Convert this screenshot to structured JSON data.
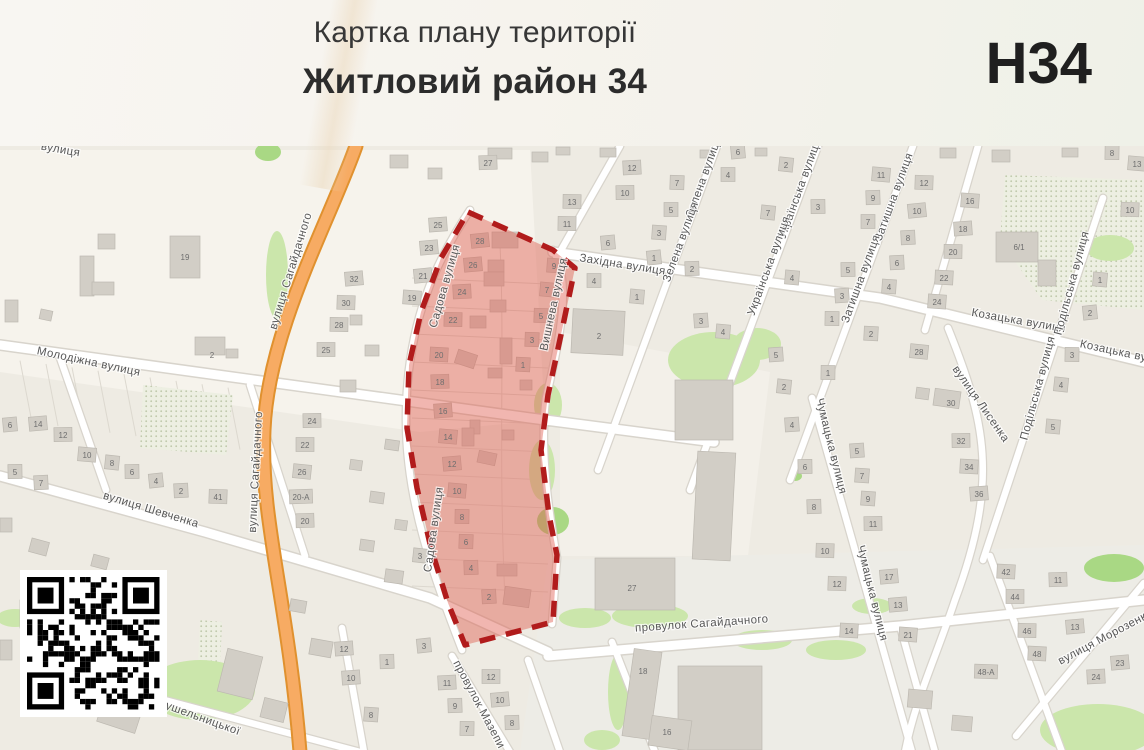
{
  "header": {
    "subtitle": "Картка плану території",
    "title": "Житловий район 34",
    "sheet_code": "Н34"
  },
  "map": {
    "colors": {
      "map_bg": "#EEEBE3",
      "highlight_fill": "#DE584C",
      "highlight_border": "#B11C1C",
      "road_orange": "#F7AB63",
      "green": "#CBE6AB",
      "building": "#D2CEC6"
    },
    "highlight": {
      "label": "Житловий район 34",
      "points": "468,212 553,250 575,268 562,330 548,395 541,450 549,515 557,555 553,622 465,645 448,603 431,548 417,488 407,428 409,365 421,312 441,258"
    },
    "street_labels": [
      [
        "Молодіжна вулиця",
        88,
        365,
        12
      ],
      [
        "вулиця Шевченка",
        150,
        513,
        17
      ],
      [
        "вулиця Сагайдачного",
        294,
        272,
        -73
      ],
      [
        "вулиця Сагайдачного",
        259,
        472,
        -87
      ],
      [
        "Західна вулиця",
        622,
        268,
        9
      ],
      [
        "Зелена вулиця",
        707,
        178,
        -70
      ],
      [
        "Зелена вулиця",
        684,
        243,
        -70
      ],
      [
        "Українська вулиця",
        803,
        190,
        -70
      ],
      [
        "Українська вулиця",
        772,
        267,
        -70
      ],
      [
        "Затишна вулиця",
        897,
        198,
        -70
      ],
      [
        "Затишна вулиця",
        864,
        280,
        -70
      ],
      [
        "Козацька вулиця",
        1018,
        324,
        10
      ],
      [
        "Козацька вулиця",
        1126,
        357,
        12
      ],
      [
        "Подільська вулиця",
        1075,
        284,
        -75
      ],
      [
        "Подільська вулиця",
        1041,
        389,
        -75
      ],
      [
        "вулиця Лисенка",
        978,
        406,
        55
      ],
      [
        "Чумацька вулиця",
        828,
        447,
        76
      ],
      [
        "Чумацька вулиця",
        869,
        594,
        76
      ],
      [
        "вулиця Морозенка",
        1107,
        640,
        -28
      ],
      [
        "провулок Сагайдачного",
        702,
        627,
        -4
      ],
      [
        "провулок Мазепи",
        476,
        706,
        62
      ],
      [
        "вулиця Крушельницької",
        175,
        712,
        20
      ],
      [
        "Садова вулиця",
        448,
        287,
        -74
      ],
      [
        "Садова вулиця",
        437,
        530,
        -82
      ],
      [
        "Вишнева вулиця",
        557,
        305,
        -78
      ],
      [
        "вулиця",
        60,
        153,
        10
      ]
    ],
    "house_numbers": [
      [
        "6",
        10,
        425
      ],
      [
        "14",
        38,
        424
      ],
      [
        "12",
        63,
        435
      ],
      [
        "10",
        87,
        455
      ],
      [
        "8",
        112,
        463
      ],
      [
        "6",
        132,
        472
      ],
      [
        "4",
        156,
        481
      ],
      [
        "2",
        181,
        491
      ],
      [
        "41",
        218,
        497
      ],
      [
        "7",
        41,
        483
      ],
      [
        "5",
        15,
        472
      ],
      [
        "2",
        212,
        355,
        0
      ],
      [
        "19",
        185,
        257,
        0
      ],
      [
        "25",
        326,
        350
      ],
      [
        "24",
        312,
        421
      ],
      [
        "22",
        305,
        445
      ],
      [
        "26",
        302,
        472
      ],
      [
        "20-А",
        301,
        497
      ],
      [
        "20",
        305,
        521
      ],
      [
        "32",
        354,
        279
      ],
      [
        "30",
        346,
        303
      ],
      [
        "28",
        339,
        325
      ],
      [
        "25",
        438,
        225
      ],
      [
        "23",
        429,
        248
      ],
      [
        "21",
        423,
        276
      ],
      [
        "19",
        412,
        298
      ],
      [
        "3",
        420,
        556
      ],
      [
        "27",
        488,
        163
      ],
      [
        "13",
        572,
        202
      ],
      [
        "11",
        567,
        224
      ],
      [
        "28",
        480,
        241
      ],
      [
        "26",
        473,
        265
      ],
      [
        "24",
        462,
        292
      ],
      [
        "22",
        453,
        320
      ],
      [
        "20",
        439,
        355
      ],
      [
        "18",
        440,
        382
      ],
      [
        "16",
        443,
        411
      ],
      [
        "14",
        448,
        437
      ],
      [
        "12",
        452,
        464
      ],
      [
        "10",
        457,
        491
      ],
      [
        "8",
        462,
        517
      ],
      [
        "6",
        466,
        542
      ],
      [
        "4",
        471,
        568
      ],
      [
        "2",
        489,
        597
      ],
      [
        "9",
        554,
        266
      ],
      [
        "7",
        547,
        290
      ],
      [
        "5",
        541,
        316
      ],
      [
        "3",
        532,
        340
      ],
      [
        "1",
        523,
        365
      ],
      [
        "6",
        608,
        243
      ],
      [
        "4",
        594,
        281
      ],
      [
        "1",
        637,
        297
      ],
      [
        "2",
        599,
        336,
        0
      ],
      [
        "12",
        632,
        168
      ],
      [
        "10",
        625,
        193
      ],
      [
        "7",
        677,
        183
      ],
      [
        "5",
        671,
        210
      ],
      [
        "3",
        659,
        233
      ],
      [
        "1",
        654,
        258
      ],
      [
        "6",
        738,
        152
      ],
      [
        "4",
        728,
        175
      ],
      [
        "2",
        786,
        165
      ],
      [
        "7",
        768,
        213
      ],
      [
        "3",
        818,
        207
      ],
      [
        "2",
        692,
        269
      ],
      [
        "3",
        701,
        321
      ],
      [
        "4",
        723,
        332
      ],
      [
        "4",
        792,
        278
      ],
      [
        "5",
        848,
        270
      ],
      [
        "3",
        842,
        296
      ],
      [
        "1",
        832,
        319
      ],
      [
        "2",
        871,
        334
      ],
      [
        "11",
        881,
        175
      ],
      [
        "9",
        873,
        198
      ],
      [
        "7",
        868,
        222
      ],
      [
        "12",
        924,
        183
      ],
      [
        "10",
        917,
        211
      ],
      [
        "8",
        908,
        238
      ],
      [
        "6",
        897,
        263
      ],
      [
        "4",
        889,
        287
      ],
      [
        "16",
        970,
        201
      ],
      [
        "18",
        963,
        229
      ],
      [
        "20",
        953,
        252
      ],
      [
        "22",
        944,
        278
      ],
      [
        "24",
        937,
        302
      ],
      [
        "28",
        919,
        352
      ],
      [
        "30",
        951,
        403,
        0
      ],
      [
        "32",
        961,
        441
      ],
      [
        "34",
        969,
        467
      ],
      [
        "36",
        979,
        494
      ],
      [
        "8",
        1112,
        153
      ],
      [
        "13",
        1137,
        164
      ],
      [
        "10",
        1130,
        210
      ],
      [
        "6/1",
        1019,
        247,
        0
      ],
      [
        "1",
        1100,
        280
      ],
      [
        "2",
        1090,
        313
      ],
      [
        "3",
        1072,
        355
      ],
      [
        "4",
        1061,
        385
      ],
      [
        "5",
        1053,
        427
      ],
      [
        "42",
        1006,
        572
      ],
      [
        "44",
        1015,
        597
      ],
      [
        "46",
        1027,
        631
      ],
      [
        "48",
        1037,
        654
      ],
      [
        "48-А",
        986,
        672
      ],
      [
        "11",
        1058,
        580
      ],
      [
        "13",
        1075,
        627
      ],
      [
        "23",
        1120,
        663
      ],
      [
        "24",
        1096,
        677
      ],
      [
        "4",
        792,
        425
      ],
      [
        "6",
        805,
        467
      ],
      [
        "8",
        814,
        507
      ],
      [
        "10",
        825,
        551
      ],
      [
        "12",
        837,
        584
      ],
      [
        "14",
        849,
        631
      ],
      [
        "5",
        857,
        451
      ],
      [
        "7",
        862,
        476
      ],
      [
        "9",
        868,
        499
      ],
      [
        "11",
        873,
        524
      ],
      [
        "17",
        889,
        577
      ],
      [
        "13",
        898,
        605
      ],
      [
        "21",
        908,
        635
      ],
      [
        "5",
        776,
        355
      ],
      [
        "1",
        828,
        373
      ],
      [
        "2",
        784,
        387
      ],
      [
        "27",
        632,
        588,
        0
      ],
      [
        "18",
        643,
        671,
        0
      ],
      [
        "16",
        667,
        732,
        0
      ],
      [
        "12",
        344,
        649
      ],
      [
        "1",
        387,
        662
      ],
      [
        "10",
        351,
        678
      ],
      [
        "3",
        424,
        646
      ],
      [
        "11",
        447,
        683
      ],
      [
        "9",
        455,
        706
      ],
      [
        "8",
        371,
        715
      ],
      [
        "7",
        467,
        729
      ],
      [
        "12",
        491,
        677
      ],
      [
        "10",
        500,
        700
      ],
      [
        "8",
        512,
        723
      ]
    ],
    "buildings": [
      [
        80,
        256,
        14,
        40,
        0
      ],
      [
        92,
        282,
        22,
        13,
        0
      ],
      [
        170,
        236,
        30,
        42,
        0
      ],
      [
        98,
        234,
        17,
        15,
        0
      ],
      [
        5,
        300,
        13,
        22,
        0
      ],
      [
        40,
        310,
        12,
        10,
        12
      ],
      [
        195,
        337,
        30,
        18,
        0
      ],
      [
        226,
        349,
        12,
        9,
        0
      ],
      [
        572,
        310,
        52,
        44,
        3
      ],
      [
        675,
        380,
        58,
        60,
        0
      ],
      [
        695,
        452,
        38,
        108,
        3
      ],
      [
        595,
        558,
        80,
        52,
        0
      ],
      [
        628,
        650,
        28,
        88,
        8
      ],
      [
        678,
        666,
        84,
        84,
        0
      ],
      [
        650,
        718,
        40,
        30,
        8
      ],
      [
        996,
        232,
        42,
        30,
        0
      ],
      [
        1038,
        260,
        18,
        26,
        0
      ],
      [
        934,
        390,
        26,
        17,
        8
      ],
      [
        916,
        388,
        13,
        11,
        8
      ],
      [
        390,
        155,
        18,
        13,
        0
      ],
      [
        428,
        168,
        14,
        11,
        0
      ],
      [
        600,
        148,
        16,
        9,
        0
      ],
      [
        488,
        148,
        24,
        11,
        0
      ],
      [
        532,
        152,
        16,
        10,
        0
      ],
      [
        556,
        147,
        14,
        8,
        0
      ],
      [
        222,
        652,
        36,
        44,
        14
      ],
      [
        262,
        700,
        24,
        20,
        14
      ],
      [
        100,
        700,
        40,
        28,
        18
      ],
      [
        20,
        600,
        14,
        28,
        0
      ],
      [
        0,
        640,
        12,
        20,
        0
      ],
      [
        310,
        640,
        22,
        16,
        10
      ],
      [
        290,
        600,
        16,
        12,
        10
      ],
      [
        385,
        570,
        18,
        13,
        8
      ],
      [
        360,
        540,
        14,
        11,
        8
      ],
      [
        395,
        520,
        12,
        10,
        8
      ],
      [
        370,
        492,
        14,
        11,
        8
      ],
      [
        350,
        460,
        12,
        10,
        8
      ],
      [
        385,
        440,
        14,
        10,
        8
      ],
      [
        340,
        380,
        16,
        12,
        0
      ],
      [
        365,
        345,
        14,
        11,
        0
      ],
      [
        350,
        315,
        12,
        10,
        0
      ],
      [
        30,
        540,
        18,
        14,
        15
      ],
      [
        92,
        556,
        16,
        12,
        15
      ],
      [
        150,
        582,
        14,
        12,
        15
      ],
      [
        0,
        518,
        12,
        14,
        0
      ],
      [
        940,
        148,
        16,
        10,
        0
      ],
      [
        992,
        150,
        18,
        12,
        0
      ],
      [
        1062,
        148,
        16,
        9,
        0
      ],
      [
        908,
        690,
        24,
        18,
        5
      ],
      [
        952,
        716,
        20,
        15,
        5
      ],
      [
        490,
        300,
        16,
        12,
        0
      ],
      [
        500,
        338,
        12,
        26,
        0
      ],
      [
        488,
        368,
        14,
        10,
        0
      ],
      [
        470,
        420,
        10,
        14,
        0
      ],
      [
        502,
        430,
        12,
        10,
        0
      ],
      [
        478,
        452,
        18,
        12,
        12
      ],
      [
        497,
        564,
        20,
        12,
        0
      ],
      [
        504,
        588,
        26,
        18,
        8
      ],
      [
        520,
        380,
        12,
        10,
        0
      ],
      [
        462,
        428,
        12,
        18,
        0
      ],
      [
        488,
        260,
        16,
        12,
        0
      ],
      [
        492,
        232,
        26,
        16,
        0
      ],
      [
        484,
        272,
        20,
        14,
        0
      ],
      [
        470,
        316,
        16,
        12,
        0
      ],
      [
        456,
        352,
        20,
        14,
        18
      ],
      [
        755,
        148,
        12,
        8,
        0
      ],
      [
        700,
        150,
        12,
        8,
        0
      ]
    ],
    "greens": [
      [
        548,
        405,
        14,
        22,
        0
      ],
      [
        542,
        470,
        13,
        30,
        0
      ],
      [
        553,
        521,
        16,
        14,
        1
      ],
      [
        714,
        360,
        46,
        28,
        0
      ],
      [
        757,
        344,
        24,
        16,
        0
      ],
      [
        585,
        618,
        26,
        10,
        0
      ],
      [
        650,
        616,
        38,
        12,
        0
      ],
      [
        762,
        640,
        30,
        10,
        0
      ],
      [
        836,
        650,
        30,
        10,
        0
      ],
      [
        872,
        606,
        20,
        8,
        0
      ],
      [
        618,
        692,
        10,
        38,
        0
      ],
      [
        602,
        740,
        18,
        10,
        0
      ],
      [
        1114,
        568,
        30,
        14,
        1
      ],
      [
        1098,
        730,
        58,
        26,
        0
      ],
      [
        1110,
        248,
        24,
        13,
        0
      ],
      [
        200,
        690,
        55,
        30,
        0
      ],
      [
        120,
        660,
        35,
        18,
        0
      ],
      [
        15,
        618,
        18,
        9,
        0
      ],
      [
        268,
        152,
        13,
        9,
        1
      ],
      [
        277,
        275,
        11,
        44,
        0
      ],
      [
        795,
        476,
        7,
        5,
        1
      ]
    ],
    "qr_code": {
      "icon": "qr-code"
    }
  }
}
